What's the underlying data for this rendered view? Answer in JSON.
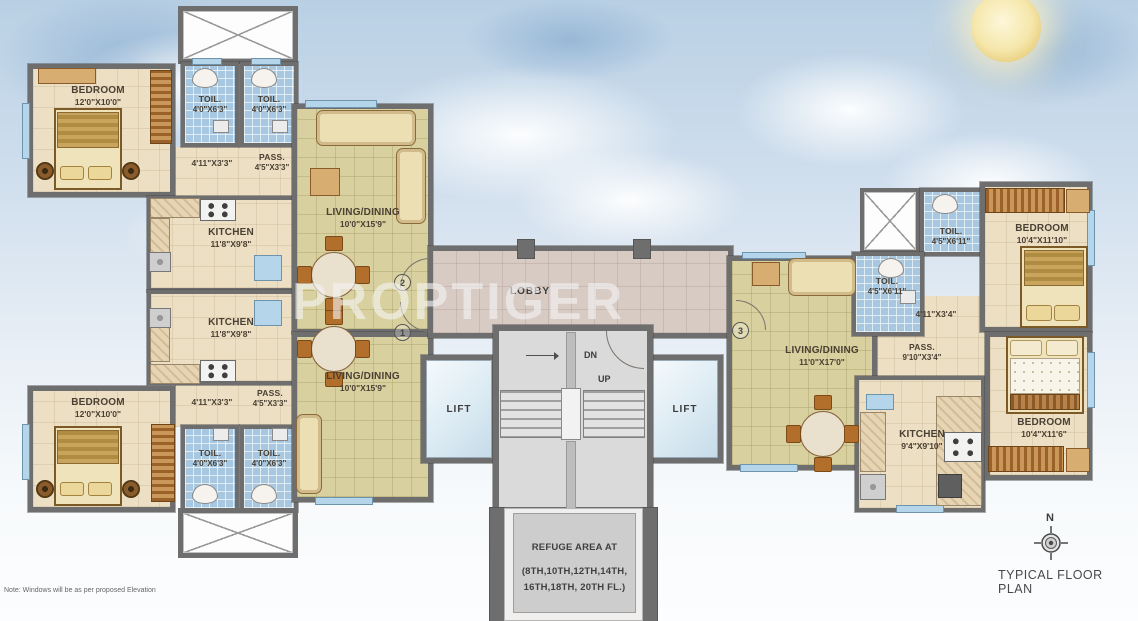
{
  "watermark": "PROPTIGER",
  "footer": {
    "note": "Note: Windows will be as per proposed Elevation",
    "plan_title": "TYPICAL FLOOR PLAN",
    "compass_north": "N"
  },
  "core": {
    "lobby_label": "LOBBY",
    "lift_left_label": "LIFT",
    "lift_right_label": "LIFT",
    "dn_label": "DN",
    "up_label": "UP",
    "refuge_line1": "REFUGE AREA AT",
    "refuge_line2": "(8TH,10TH,12TH,14TH,",
    "refuge_line3": "16TH,18TH, 20TH FL.)"
  },
  "markers": {
    "flat1": "1",
    "flat2": "2",
    "flat3": "3"
  },
  "flat_a": {
    "bedroom_name": "BEDROOM",
    "bedroom_dims": "12'0\"X10'0\"",
    "toilet1_name": "TOIL.",
    "toilet1_dims": "4'0\"X6'3\"",
    "toilet2_name": "TOIL.",
    "toilet2_dims": "4'0\"X6'3\"",
    "corridor_dims": "4'11\"X3'3\"",
    "pass_name": "PASS.",
    "pass_dims": "4'5\"X3'3\"",
    "kitchen_name": "KITCHEN",
    "kitchen_dims": "11'8\"X9'8\"",
    "living_name": "LIVING/DINING",
    "living_dims": "10'0\"X15'9\""
  },
  "flat_b": {
    "bedroom_name": "BEDROOM",
    "bedroom_dims": "12'0\"X10'0\"",
    "toilet1_name": "TOIL.",
    "toilet1_dims": "4'0\"X6'3\"",
    "toilet2_name": "TOIL.",
    "toilet2_dims": "4'0\"X6'3\"",
    "corridor_dims": "4'11\"X3'3\"",
    "pass_name": "PASS.",
    "pass_dims": "4'5\"X3'3\"",
    "kitchen_name": "KITCHEN",
    "kitchen_dims": "11'8\"X9'8\"",
    "living_name": "LIVING/DINING",
    "living_dims": "10'0\"X15'9\""
  },
  "flat_c": {
    "toilet_top_name": "TOIL.",
    "toilet_top_dims": "4'5\"X6'11\"",
    "toilet_mid_name": "TOIL.",
    "toilet_mid_dims": "4'5\"X6'11\"",
    "bedroom_top_name": "BEDROOM",
    "bedroom_top_dims": "10'4\"X11'10\"",
    "corridor_dims": "4'11\"X3'4\"",
    "pass_name": "PASS.",
    "pass_dims": "9'10\"X3'4\"",
    "living_name": "LIVING/DINING",
    "living_dims": "11'0\"X17'0\"",
    "kitchen_name": "KITCHEN",
    "kitchen_dims": "9'4\"X9'10\"",
    "bedroom_bottom_name": "BEDROOM",
    "bedroom_bottom_dims": "10'4\"X11'6\""
  },
  "colors": {
    "wall": "#6e6e6e",
    "living_floor": "#d8d09e",
    "bedroom_floor": "#ecdfc3",
    "toilet_floor": "#a7c8e0",
    "lobby_floor": "#d7cbc4",
    "stair_floor": "#dadada",
    "window": "#b5d6ea",
    "moon": "#f5e7ab"
  }
}
